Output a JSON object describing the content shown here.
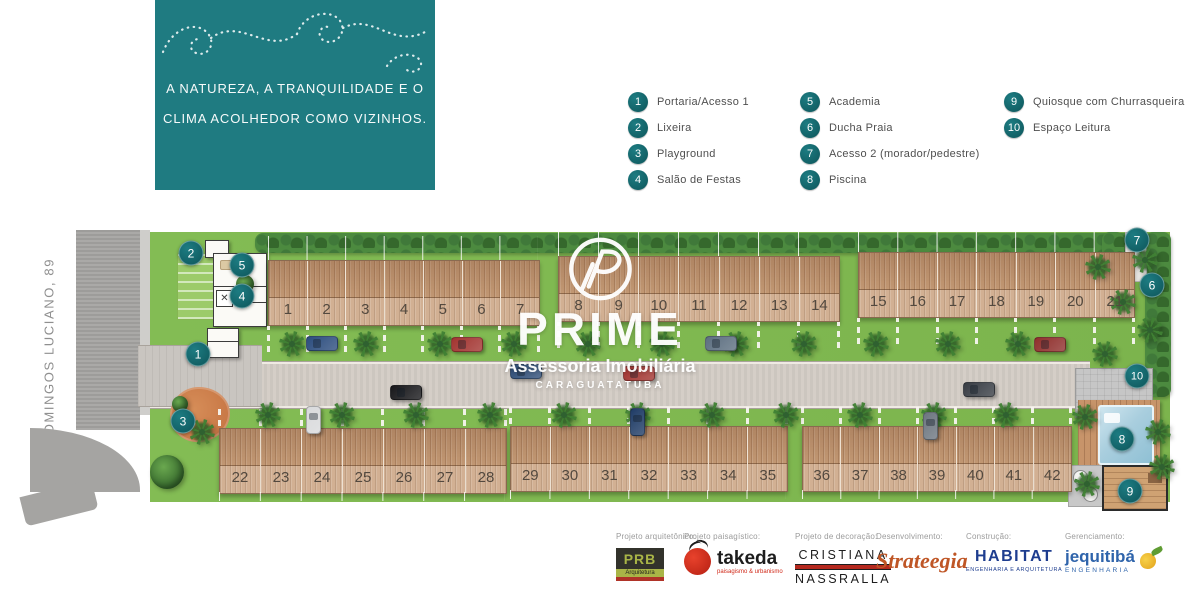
{
  "brand_box": {
    "line1": "A NATUREZA, A TRANQUILIDADE E O",
    "line2": "CLIMA ACOLHEDOR COMO VIZINHOS."
  },
  "legend": {
    "columns": [
      {
        "x": 628,
        "items": [
          {
            "num": "1",
            "label": "Portaria/Acesso 1"
          },
          {
            "num": "2",
            "label": "Lixeira"
          },
          {
            "num": "3",
            "label": "Playground"
          },
          {
            "num": "4",
            "label": "Salão de Festas"
          }
        ]
      },
      {
        "x": 800,
        "items": [
          {
            "num": "5",
            "label": "Academia"
          },
          {
            "num": "6",
            "label": "Ducha Praia"
          },
          {
            "num": "7",
            "label": "Acesso 2 (morador/pedestre)"
          },
          {
            "num": "8",
            "label": "Piscina"
          }
        ]
      },
      {
        "x": 1004,
        "items": [
          {
            "num": "9",
            "label": "Quiosque com Churrasqueira"
          },
          {
            "num": "10",
            "label": "Espaço Leitura"
          }
        ]
      }
    ]
  },
  "street_label": "RUA DOMINGOS LUCIANO, 89",
  "watermark": {
    "name": "PRIME",
    "subtitle": "Assessoria Imobiliária",
    "city": "CARAGUATATUBA"
  },
  "site": {
    "unit_blocks": [
      {
        "row": "top",
        "units": [
          "1",
          "2",
          "3",
          "4",
          "5",
          "6",
          "7"
        ]
      },
      {
        "row": "top",
        "units": [
          "8",
          "9",
          "10",
          "11",
          "12",
          "13",
          "14"
        ]
      },
      {
        "row": "top",
        "units": [
          "15",
          "16",
          "17",
          "18",
          "19",
          "20",
          "21"
        ]
      },
      {
        "row": "bottom",
        "units": [
          "22",
          "23",
          "24",
          "25",
          "26",
          "27",
          "28"
        ]
      },
      {
        "row": "bottom",
        "units": [
          "29",
          "30",
          "31",
          "32",
          "33",
          "34",
          "35"
        ]
      },
      {
        "row": "bottom",
        "units": [
          "36",
          "37",
          "38",
          "39",
          "40",
          "41",
          "42"
        ]
      }
    ],
    "markers": [
      {
        "num": "1",
        "x": 198,
        "y": 354
      },
      {
        "num": "2",
        "x": 191,
        "y": 253
      },
      {
        "num": "3",
        "x": 183,
        "y": 421
      },
      {
        "num": "4",
        "x": 242,
        "y": 296
      },
      {
        "num": "5",
        "x": 242,
        "y": 265
      },
      {
        "num": "6",
        "x": 1152,
        "y": 285
      },
      {
        "num": "7",
        "x": 1137,
        "y": 240
      },
      {
        "num": "8",
        "x": 1122,
        "y": 439
      },
      {
        "num": "9",
        "x": 1130,
        "y": 491
      },
      {
        "num": "10",
        "x": 1137,
        "y": 376
      }
    ]
  },
  "footer": {
    "partners": [
      {
        "role": "Projeto arquitetônico:",
        "name": "PRB",
        "sub": "Arquitetura"
      },
      {
        "role": "Projeto paisagístico:",
        "name": "takeda",
        "sub": "paisagismo & urbanismo"
      },
      {
        "role": "Projeto de decoração:",
        "name": "CRISTIANA",
        "name2": "NASSRALLA"
      },
      {
        "role": "Desenvolvimento:",
        "name": "Strateegia"
      },
      {
        "role": "Construção:",
        "name": "HABITAT",
        "sub": "ENGENHARIA E ARQUITETURA"
      },
      {
        "role": "Gerenciamento:",
        "name": "jequitibá",
        "sub": "ENGENHARIA"
      }
    ]
  },
  "colors": {
    "teal": "#1f7b81",
    "marker_teal": "#15696e",
    "grass": "#7cb94f",
    "hedge": "#3c7534",
    "wood": "#c79d78",
    "road": "#d3ccc5",
    "side_road": "#a5a4a2",
    "pool": "#a9cede",
    "deck": "#c7946a",
    "playground": "#cd7f4e"
  }
}
